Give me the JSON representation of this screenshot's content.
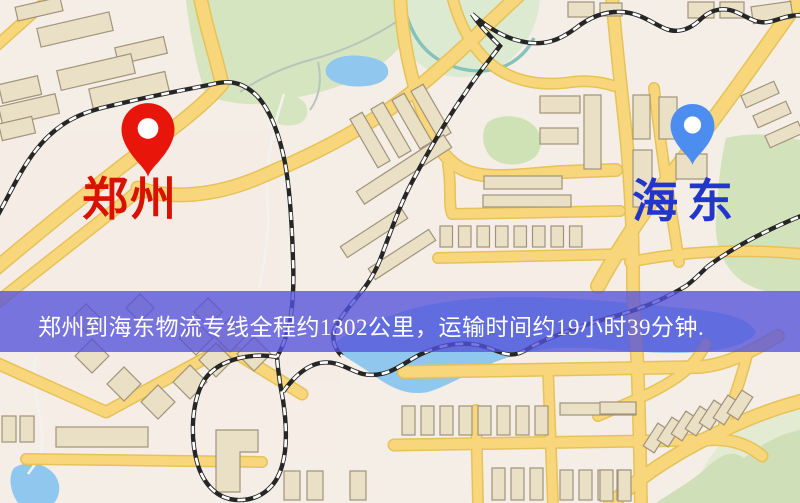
{
  "map": {
    "origin_marker": {
      "label": "郑州",
      "pin_color": "#e8150a",
      "label_color": "#d81100",
      "icon": "map-pin"
    },
    "destination_marker": {
      "label": "海东",
      "pin_color": "#4d8df0",
      "label_color": "#2236cc",
      "icon": "map-pin"
    },
    "banner": {
      "text": "郑州到海东物流专线全程约1302公里，运输时间约19小时39分钟.",
      "background_color": "#5452db",
      "text_color": "#ffffff"
    },
    "route_info": {
      "origin": "郑州",
      "destination": "海东",
      "distance_km": "1302",
      "duration": "19小时39分钟"
    },
    "palette": {
      "map_background": "#f4eee6",
      "road_yellow": "#f8d77c",
      "green_area": "#d5e5bf",
      "water_blue": "#8fc7ee",
      "railway": "#262626"
    }
  }
}
